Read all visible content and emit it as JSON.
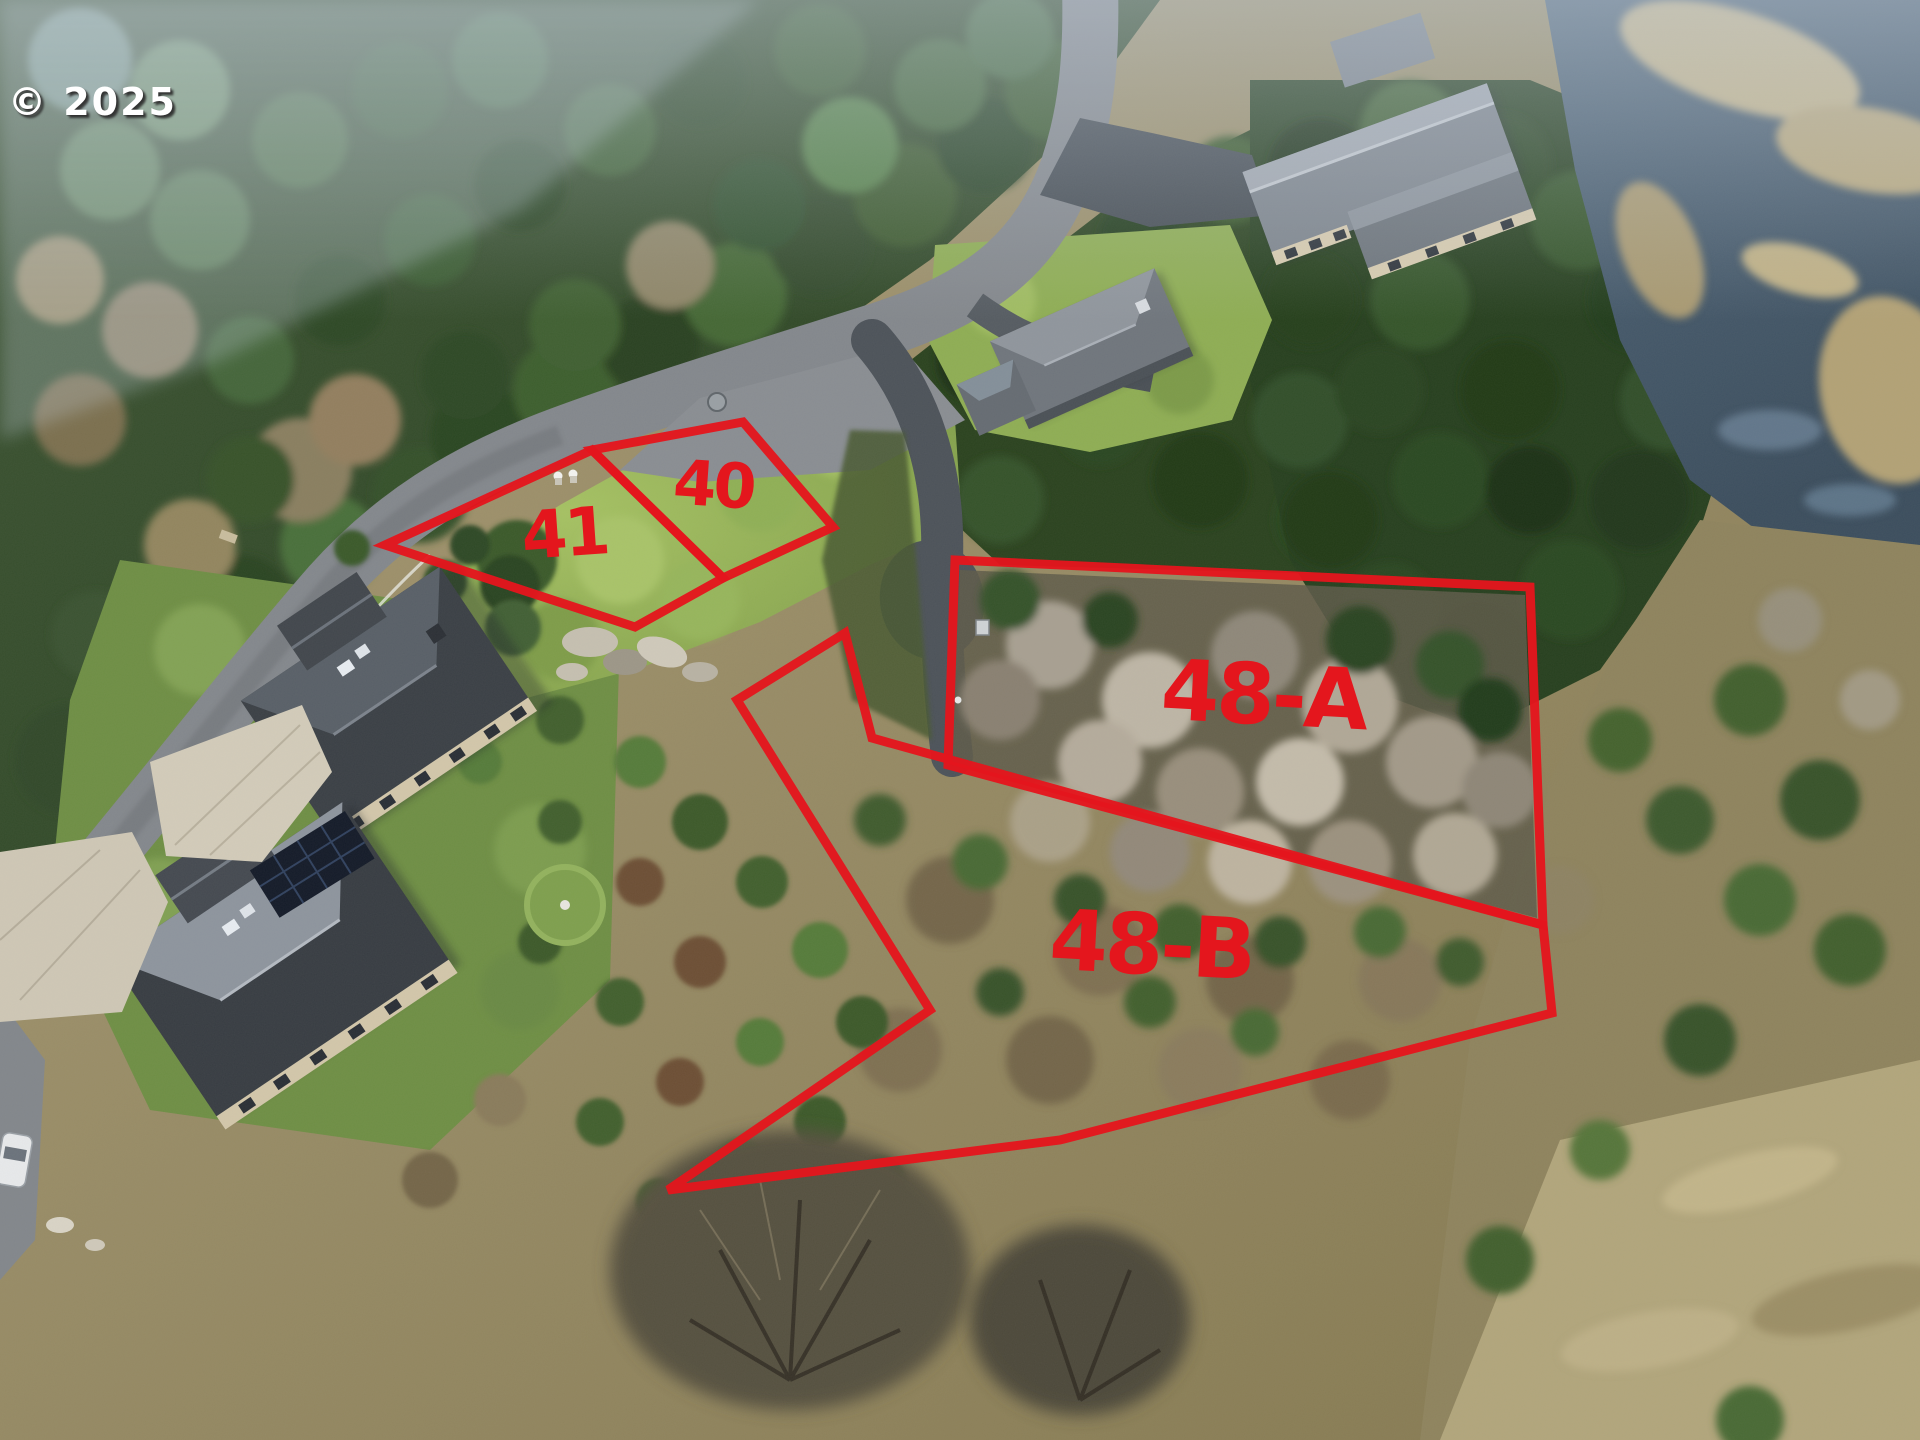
{
  "watermark": {
    "text": "© 2025"
  },
  "annotations": {
    "color": "#e4161d",
    "line_width": 9,
    "lots": [
      {
        "id": "41",
        "label": "41",
        "label_x": 566,
        "label_y": 556,
        "font_size": 66,
        "rotate": -4,
        "points": "385,545 592,450 723,578 635,627"
      },
      {
        "id": "40",
        "label": "40",
        "label_x": 712,
        "label_y": 506,
        "font_size": 62,
        "rotate": 4,
        "points": "592,450 743,422 833,527 723,578"
      },
      {
        "id": "48-A",
        "label": "48-A",
        "label_x": 1262,
        "label_y": 724,
        "font_size": 84,
        "rotate": 3,
        "points": "955,560 1530,587 1543,925 948,765"
      },
      {
        "id": "48-B",
        "label": "48-B",
        "label_x": 1150,
        "label_y": 974,
        "font_size": 84,
        "rotate": 3,
        "points": "845,633 872,738 1543,925 1552,1013 1060,1140 668,1190 930,1010 737,700"
      }
    ]
  }
}
